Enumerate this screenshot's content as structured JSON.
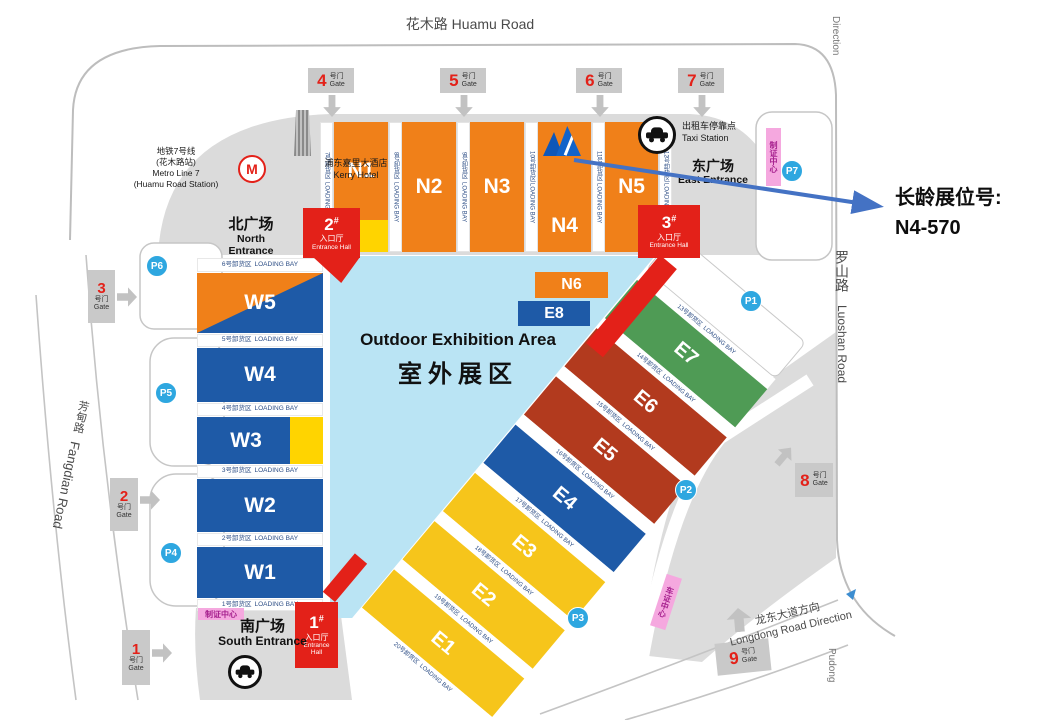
{
  "roads": {
    "top": "花木路  Huamu Road",
    "right_cn": "罗山路",
    "right_en": "Luoshan Road",
    "left_cn": "芳甸路",
    "left_en": "Fangdian Road",
    "direction": "Direction",
    "longdong_cn": "龙东大道方向",
    "longdong_en": "Longdong Road Direction",
    "pudong": "Pudong"
  },
  "annotation": {
    "line1": "长龄展位号:",
    "line2": "N4-570"
  },
  "gates": {
    "cn_label": "号门",
    "en_label": "Gate",
    "numbers": [
      "1",
      "2",
      "3",
      "4",
      "5",
      "6",
      "7",
      "8",
      "9"
    ]
  },
  "entrance_halls": {
    "cn": "入口厅",
    "en": "Entrance Hall",
    "sup": "#",
    "numbers": [
      "1",
      "2",
      "3"
    ]
  },
  "entrances": {
    "north_cn": "北广场",
    "north_en1": "North",
    "north_en2": "Entrance",
    "east_cn": "东广场",
    "east_en": "East Entrance",
    "south_cn": "南广场",
    "south_en": "South Entrance"
  },
  "metro": {
    "l1": "地铁7号线",
    "l2": "(花木路站)",
    "l3": "Metro Line 7",
    "l4": "(Huamu Road Station)"
  },
  "hotel": {
    "cn": "浦东嘉里大酒店",
    "en": "Kerry Hotel"
  },
  "taxi": {
    "cn": "出租车停靠点",
    "en": "Taxi Station"
  },
  "outdoor": {
    "en": "Outdoor Exhibition Area",
    "cn": "室外展区"
  },
  "halls": {
    "n": [
      "N1",
      "N2",
      "N3",
      "N4",
      "N5"
    ],
    "n6": "N6",
    "e8": "E8",
    "w": [
      "W5",
      "W4",
      "W3",
      "W2",
      "W1"
    ],
    "e": [
      "E7",
      "E6",
      "E5",
      "E4",
      "E3",
      "E2",
      "E1"
    ]
  },
  "bays": {
    "en": "LOADING BAY",
    "cn": [
      "1号卸货区",
      "2号卸货区",
      "3号卸货区",
      "4号卸货区",
      "5号卸货区",
      "6号卸货区",
      "7号卸货区",
      "8号卸货区",
      "9号卸货区",
      "10号卸货区",
      "11号卸货区",
      "12号卸货区",
      "13号卸货区",
      "14号卸货区",
      "15号卸货区",
      "16号卸货区",
      "17号卸货区",
      "18号卸货区",
      "19号卸货区",
      "20号卸货区"
    ]
  },
  "parking": [
    "P1",
    "P2",
    "P3",
    "P4",
    "P5",
    "P6",
    "P7"
  ],
  "service_labels": {
    "zhizheng": "制证中心",
    "chezheng": "车证中心"
  },
  "colors": {
    "hall_orange": "#F08019",
    "hall_blue": "#1E5AA7",
    "hall_yellow": "#F6C51B",
    "n1_yellow": "#FFD400",
    "hall_dark_red": "#B23A1E",
    "hall_green": "#4F9B55",
    "outdoor_blue": "#BAE4F4",
    "entrance_red": "#E32119",
    "parking_blue": "#2EA7E0",
    "pink_label_bg": "#F5A8DF",
    "pink_label_text": "#A6208E",
    "annotation_arrow_blue": "#4472C4",
    "gate_gray": "#C9C9C9"
  }
}
